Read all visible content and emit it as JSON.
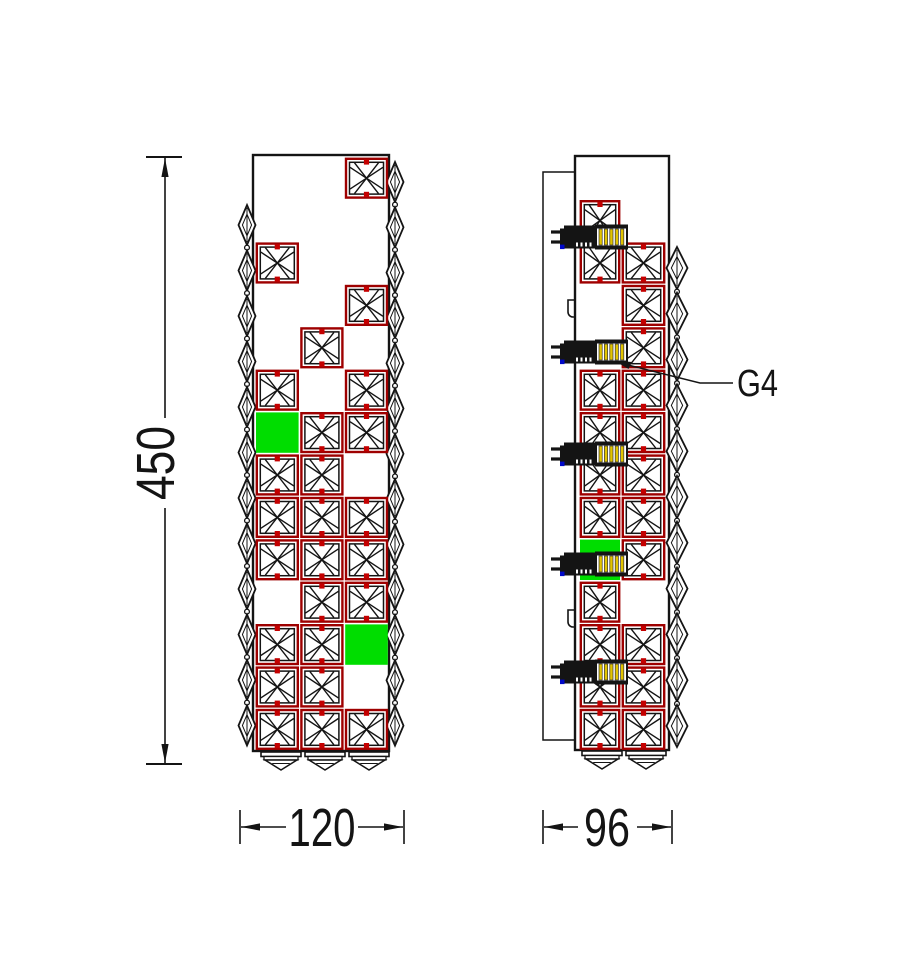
{
  "drawing": {
    "type": "technical-cad-drawing",
    "subject": "crystal wall sconce - front and side elevations",
    "labels": {
      "height": "450",
      "front_width": "120",
      "side_width": "96",
      "lamp_callout": "G4"
    },
    "colors": {
      "line": "#141414",
      "crystal_frame_red": "#9e0000",
      "clip_red": "#c40000",
      "green_crystal": "#00dd00",
      "bulb_yellow": "#e2c400",
      "wire_blue": "#0008c8",
      "background": "#ffffff"
    },
    "front_view": {
      "grid": {
        "rows": 14,
        "cols": 3
      },
      "crystal_cells": [
        [
          1,
          3
        ],
        [
          3,
          1
        ],
        [
          4,
          3
        ],
        [
          5,
          2
        ],
        [
          6,
          1
        ],
        [
          6,
          3
        ],
        [
          7,
          2
        ],
        [
          7,
          3
        ],
        [
          8,
          1
        ],
        [
          8,
          2
        ],
        [
          9,
          1
        ],
        [
          9,
          2
        ],
        [
          9,
          3
        ],
        [
          10,
          1
        ],
        [
          10,
          2
        ],
        [
          10,
          3
        ],
        [
          11,
          2
        ],
        [
          11,
          3
        ],
        [
          12,
          1
        ],
        [
          12,
          2
        ],
        [
          13,
          1
        ],
        [
          13,
          2
        ],
        [
          14,
          1
        ],
        [
          14,
          2
        ],
        [
          14,
          3
        ]
      ],
      "green_cells": [
        [
          7,
          1
        ],
        [
          12,
          3
        ]
      ],
      "left_bead_count": 12,
      "right_bead_count": 13,
      "fringe_fan_count": 3
    },
    "side_view": {
      "grid": {
        "rows": 14,
        "cols": 2
      },
      "crystal_cells": [
        [
          2,
          1
        ],
        [
          3,
          1
        ],
        [
          6,
          1
        ],
        [
          7,
          1
        ],
        [
          8,
          1
        ],
        [
          9,
          1
        ],
        [
          11,
          1
        ],
        [
          12,
          1
        ],
        [
          13,
          1
        ],
        [
          14,
          1
        ],
        [
          3,
          2
        ],
        [
          4,
          2
        ],
        [
          5,
          2
        ],
        [
          6,
          2
        ],
        [
          7,
          2
        ],
        [
          8,
          2
        ],
        [
          9,
          2
        ],
        [
          10,
          2
        ],
        [
          12,
          2
        ],
        [
          13,
          2
        ],
        [
          14,
          2
        ]
      ],
      "green_cells": [
        [
          10,
          1
        ]
      ],
      "lamp_y_centers": [
        237,
        352,
        454,
        564,
        672
      ],
      "right_bead_count": 11,
      "fringe_fan_count": 2
    }
  }
}
